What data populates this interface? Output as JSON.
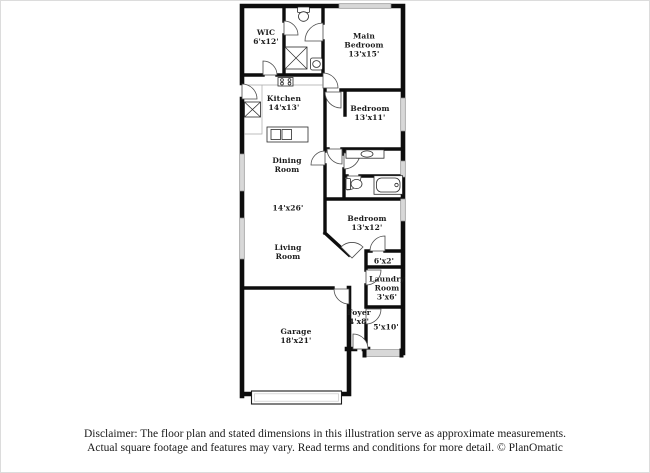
{
  "floorplan": {
    "rooms": {
      "wic": {
        "name": "WIC",
        "dims": "6'x12'"
      },
      "main_bedroom": {
        "name": "Main Bedroom",
        "dims": "13'x15'"
      },
      "kitchen": {
        "name": "Kitchen",
        "dims": "14'x13'"
      },
      "bedroom2": {
        "name": "Bedroom",
        "dims": "13'x11'"
      },
      "dining_room": {
        "name": "Dining Room",
        "dims": ""
      },
      "open_area": {
        "name": "",
        "dims": "14'x26'"
      },
      "bedroom3": {
        "name": "Bedroom",
        "dims": "13'x12'"
      },
      "living_room": {
        "name": "Living Room",
        "dims": ""
      },
      "closet": {
        "name": "",
        "dims": "6'x2'"
      },
      "laundry": {
        "name": "Laundry Room",
        "dims": "3'x6'"
      },
      "foyer": {
        "name": "Foyer",
        "dims": "4'x8'"
      },
      "porch": {
        "name": "",
        "dims": "5'x10'"
      },
      "garage": {
        "name": "Garage",
        "dims": "18'x21'"
      }
    }
  },
  "disclaimer": {
    "line1": "Disclaimer: The floor plan and stated dimensions in this illustration serve as approximate measurements.",
    "line2": "Actual square footage and features may vary. Read terms and conditions for more detail. © PlanOmatic"
  },
  "colors": {
    "wall": "#0d0d0d",
    "window": "#d8d8d8",
    "background": "#ffffff",
    "text": "#1c1c1c"
  }
}
